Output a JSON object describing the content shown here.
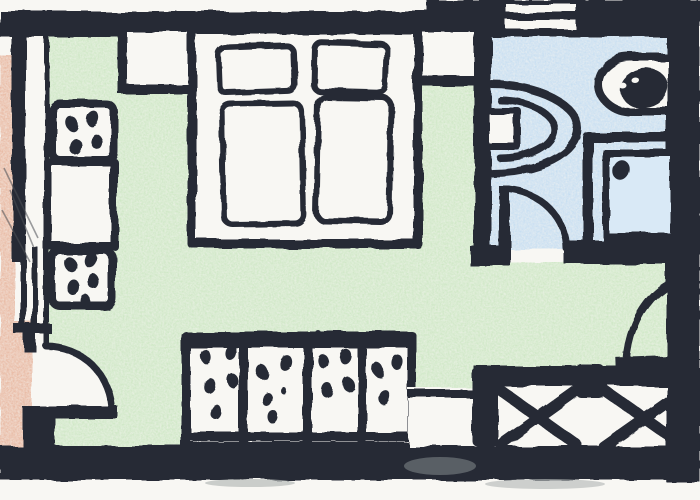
{
  "document": {
    "type": "hand-drawn apartment floor plan, ink with colored pencil",
    "title": "",
    "visible_text": "none"
  },
  "palette": {
    "ink": "#262b36",
    "paper": "#f8f7f3",
    "room_green": "#cde7c4",
    "room_blue": "#c5ddf1",
    "room_pink": "#e8b7a0",
    "shower_blue": "#d9e9f6",
    "smudge_gray": "#b6bab8",
    "css": "--ink:#262b36; --paper:#f8f7f3; --green:#cde7c4; --blue:#c5ddf1; --pink:#e8b7a0; --shower:#d9e9f6; --smudge:#b6bab8"
  },
  "rooms": {
    "living_sleeping_room": {
      "fill": "room_green",
      "position": "center"
    },
    "bathroom": {
      "fill": "room_blue",
      "position": "top-right"
    },
    "side_room_partial": {
      "fill": "room_pink",
      "position": "left-edge"
    },
    "balcony_strip": {
      "fill": "paper",
      "position": "bottom-right"
    }
  },
  "fixtures": {
    "double_bed": {
      "pillows": 2,
      "duvets": 2,
      "wall": "top"
    },
    "nightstands": 2,
    "kitchen_hob_upper": {
      "burner_dots": 4
    },
    "kitchen_counter": {
      "dots": 0
    },
    "kitchen_hob_lower": {
      "burner_dots": 5
    },
    "wardrobe": {
      "panels": 4,
      "dot_pattern": true,
      "wall": "bottom"
    },
    "toilet": {
      "wall": "bathroom-left",
      "tank": true
    },
    "wash_basin": {
      "wall": "bathroom-right"
    },
    "shower": {
      "drain_dot": true,
      "shape": "square"
    },
    "window_top_wall": {
      "stripes": 2
    },
    "doors": {
      "left_room_door": "quarter-arc",
      "bathroom_door": "quarter-arc",
      "balcony_door": "quarter-arc"
    },
    "balcony_railing": {
      "x_panels": 2,
      "posts": 2
    }
  }
}
